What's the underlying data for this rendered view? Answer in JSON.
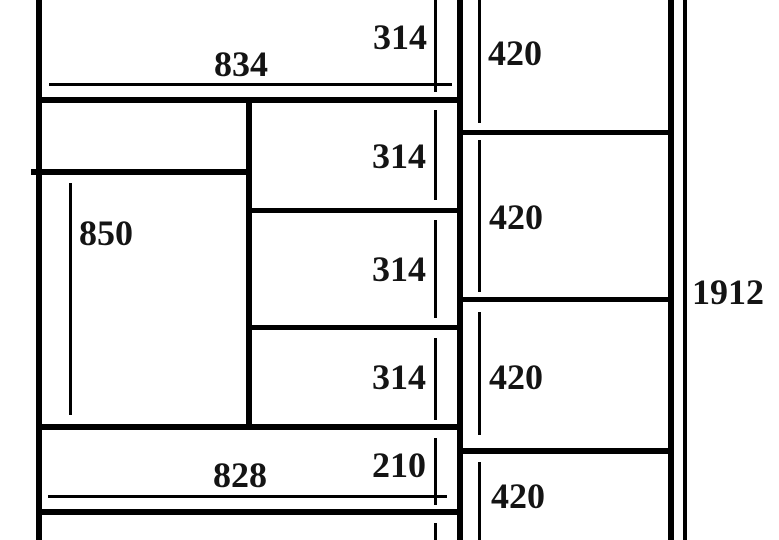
{
  "labels": {
    "w834": "834",
    "h314_1": "314",
    "h314_2": "314",
    "h314_3": "314",
    "h314_4": "314",
    "v420_1": "420",
    "v420_2": "420",
    "v420_3": "420",
    "v420_4": "420",
    "h850": "850",
    "w828": "828",
    "h210": "210",
    "total_1912": "1912"
  },
  "colors": {
    "line": "#000000",
    "text": "#141414",
    "background": "#ffffff"
  }
}
